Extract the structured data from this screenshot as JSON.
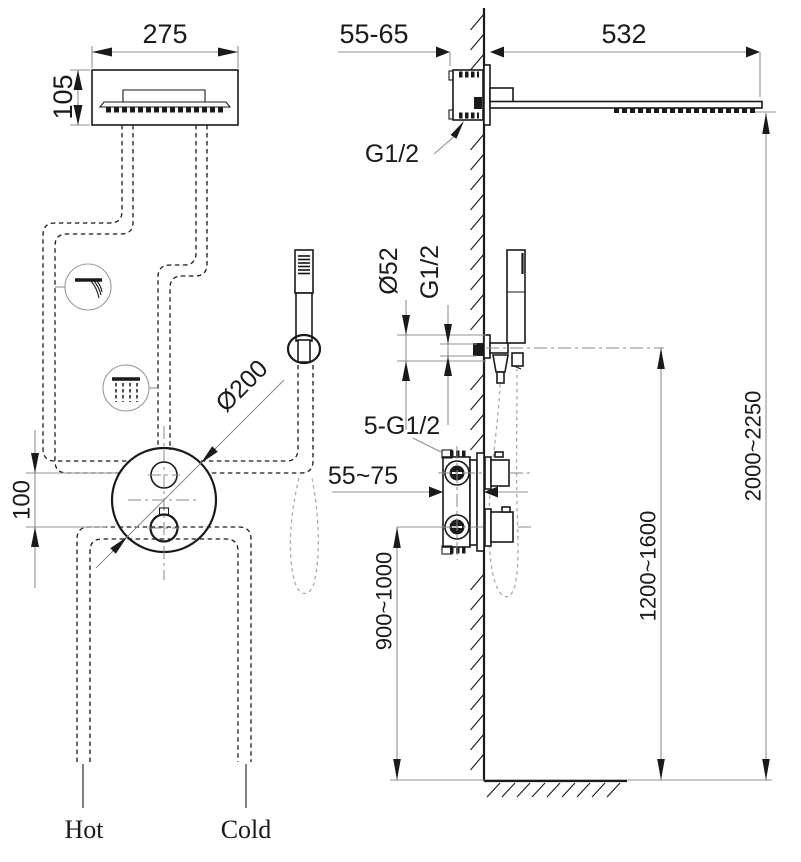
{
  "drawing": {
    "front_view": {
      "head_width": "275",
      "head_depth": "105",
      "port_offset": "100",
      "plate_diameter": "Ø200",
      "hot_label": "Hot",
      "cold_label": "Cold"
    },
    "side_view": {
      "wall_depth": "55-65",
      "arm_length": "532",
      "arm_thread": "G1/2",
      "holder_diameter": "Ø52",
      "holder_thread": "G1/2",
      "valve_connections": "5-G1/2",
      "valve_depth": "55~75",
      "valve_height": "900~1000",
      "holder_height": "1200~1600",
      "head_height": "2000~2250"
    }
  },
  "colors": {
    "line": "#1a1a1a",
    "dim": "#909090",
    "hose": "#ababab"
  }
}
